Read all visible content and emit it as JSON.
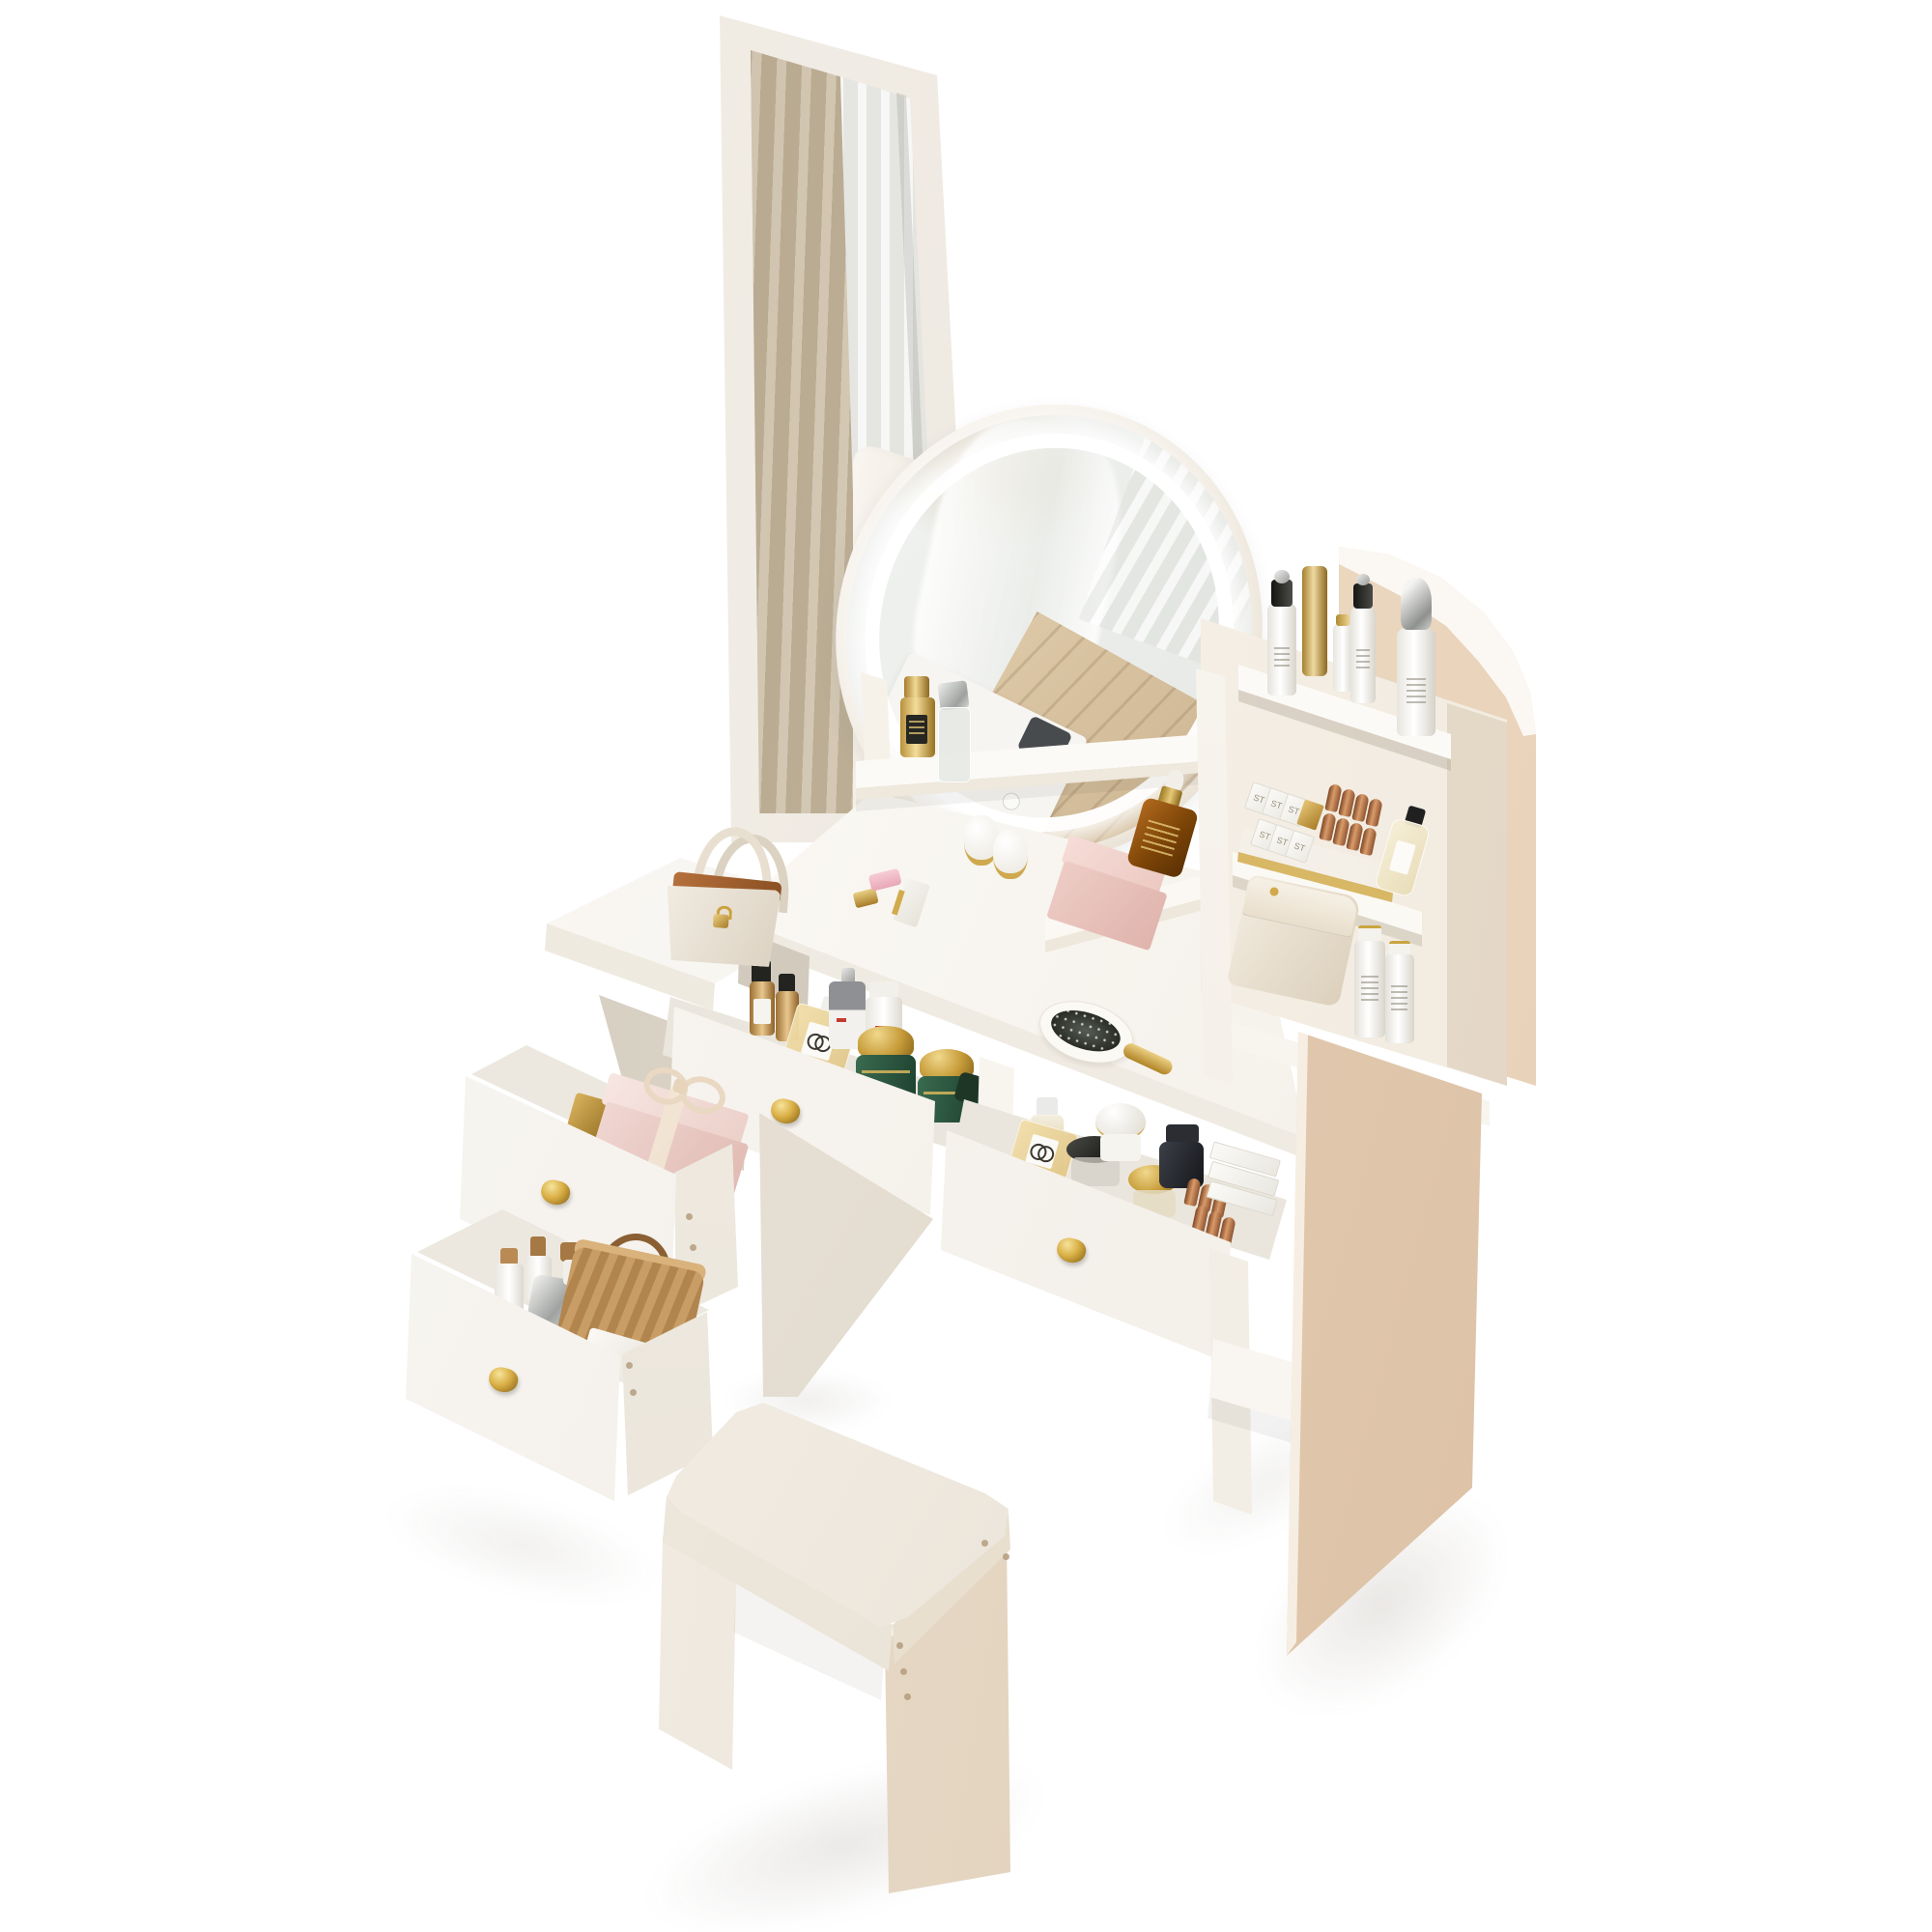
{
  "background_color": "#ffffff",
  "labels": {
    "lipstick_box": "ST"
  },
  "palette": {
    "furniture_white": "#f8f5f0",
    "furniture_shadow": "#ece6db",
    "beige_side_panel": "#e7cfb3",
    "gold_hardware": "#d5aa43",
    "curtain_reflection": "#c6b89e",
    "pink_box": "#eed2cc",
    "green_jar": "#2f5c42",
    "amber_bottle": "#8a4c10",
    "copper_lipstick": "#b4714a",
    "led_light": "#ffffff"
  },
  "furniture": {
    "full_length_mirror": "white framed full-length mirror reflecting a beige curtain and bright window",
    "led_mirror": "oval vanity mirror with glowing LED ring and touch button",
    "hutch": "right storage hutch with curved beige side panel and three shelves of cosmetics",
    "desk": "white vanity desk with two pulled-out drawers and gold cone knobs",
    "side_cabinet": "left side cabinet with two pulled-out drawers and gold cone knobs",
    "stool": "white vanity stool with padded leather cushion",
    "open_drawer_count": 4
  },
  "cosmetics": {
    "hutch_top_shelf": [
      "white pump bottle with black cap",
      "gold cylinder bottle",
      "small white bottle",
      "white pump bottle with black cap",
      "white bottle with silver dome cap"
    ],
    "hutch_middle_shelf": [
      "tray of white ST lipstick boxes",
      "gold lipstick box",
      "copper lipstick bullets",
      "pale yellow perfume with black cap"
    ],
    "hutch_lower_shelf": [
      "cream leather pouch with gold snap",
      "two white spray bottles"
    ],
    "organizer_shelf": [
      "gold serum bottle with black label",
      "clear bottle with silver cap",
      "two white jars with gold bands",
      "pink two-tier box",
      "amber dropper bottle with gold collar"
    ],
    "desktop": [
      "pink and gold lipstick",
      "white lipstick case",
      "white paddle hair brush with gold handle"
    ],
    "middle_drawer": [
      "two amber bottles with black caps",
      "square amber perfume with CC monogram",
      "grey pump bottle",
      "white jar",
      "two green jars with gold dome lids",
      "dark green flat jar"
    ],
    "right_drawer": [
      "clear gold bottle",
      "square CC perfume",
      "black flat jar",
      "white dome jar",
      "gold lid jar",
      "dark jar",
      "copper lipstick bullets",
      "stack of white lipstick boxes"
    ],
    "left_upper_drawer": [
      "pink gift box with cream ribbon bow",
      "gold box"
    ],
    "left_lower_drawer": [
      "woven basket with rope handle",
      "bottles with cork caps",
      "silver bottle",
      "white box",
      "pearl ball"
    ],
    "side_table_top": [
      "cream mini handbag with tan trim and gold padlock charm"
    ]
  }
}
